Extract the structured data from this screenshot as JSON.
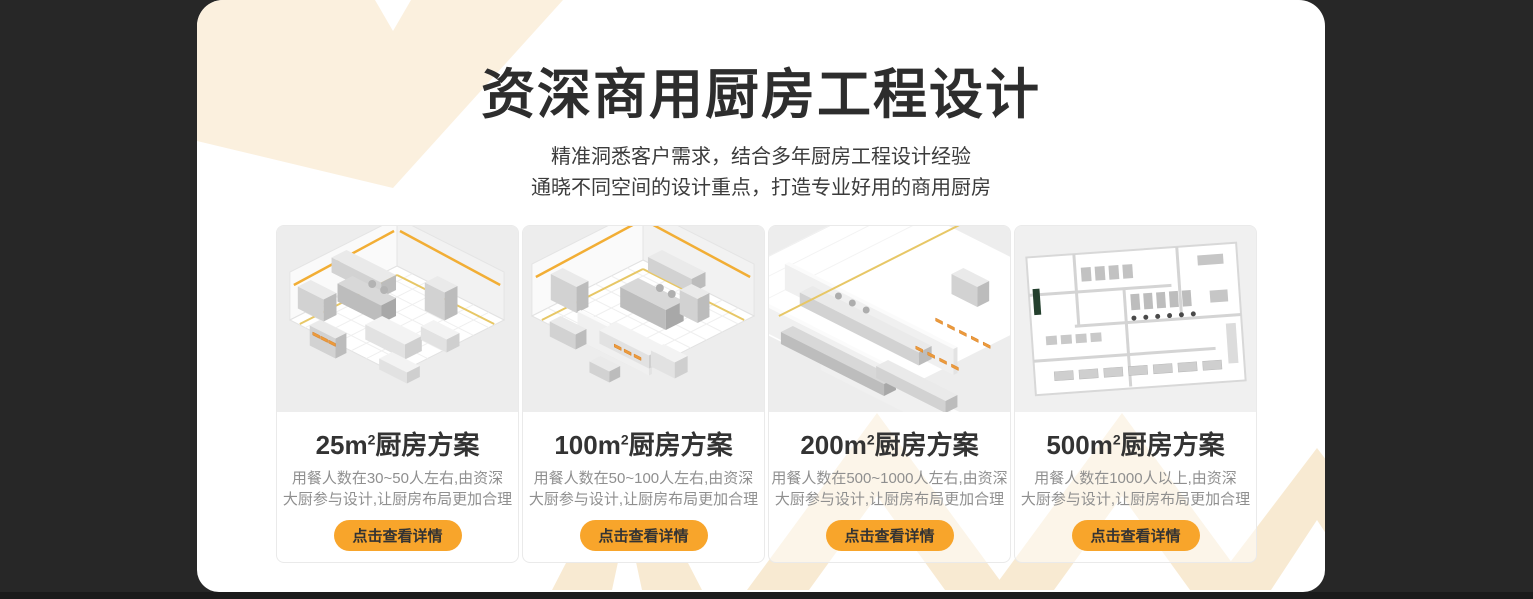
{
  "theme": {
    "page_background": "#272727",
    "bottom_strip": "#1b1b1b",
    "panel_background": "#ffffff",
    "accent_orange": "#F8A52B",
    "cream_decoration": "#FBF0DE",
    "cream_decoration_deep": "#F8EAD2",
    "title_color": "#2d2d2d",
    "description_color": "#8f8f8f"
  },
  "header": {
    "title": "资深商用厨房工程设计",
    "subtitle_line1": "精准洞悉客户需求，结合多年厨房工程设计经验",
    "subtitle_line2": "通晓不同空间的设计重点，打造专业好用的商用厨房"
  },
  "cards": [
    {
      "area": "25m",
      "area_sup": "2",
      "title_suffix": "厨房方案",
      "desc_line1": "用餐人数在30~50人左右,由资深",
      "desc_line2": "大厨参与设计,让厨房布局更加合理",
      "button_label": "点击查看详情",
      "image": "isometric-kitchen-render-25sqm"
    },
    {
      "area": "100m",
      "area_sup": "2",
      "title_suffix": "厨房方案",
      "desc_line1": "用餐人数在50~100人左右,由资深",
      "desc_line2": "大厨参与设计,让厨房布局更加合理",
      "button_label": "点击查看详情",
      "image": "isometric-kitchen-render-100sqm"
    },
    {
      "area": "200m",
      "area_sup": "2",
      "title_suffix": "厨房方案",
      "desc_line1": "用餐人数在500~1000人左右,由资深",
      "desc_line2": "大厨参与设计,让厨房布局更加合理",
      "button_label": "点击查看详情",
      "image": "isometric-kitchen-render-200sqm"
    },
    {
      "area": "500m",
      "area_sup": "2",
      "title_suffix": "厨房方案",
      "desc_line1": "用餐人数在1000人以上,由资深",
      "desc_line2": "大厨参与设计,让厨房布局更加合理",
      "button_label": "点击查看详情",
      "image": "isometric-kitchen-render-500sqm"
    }
  ]
}
